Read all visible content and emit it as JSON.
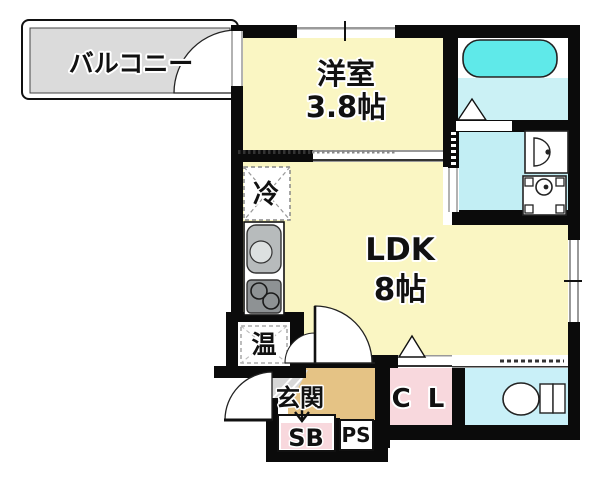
{
  "plan_title": "apartment-floor-plan",
  "rooms": {
    "balcony": {
      "label": "バルコニー"
    },
    "western_room": {
      "label": "洋室",
      "size": "3.8帖"
    },
    "ldk": {
      "label": "LDK",
      "size": "8帖"
    },
    "entrance": {
      "label": "玄関"
    },
    "closet": {
      "label": "C L"
    },
    "shoe_box": {
      "label": "SB"
    },
    "pipe_space": {
      "label": "PS"
    }
  },
  "fixtures": {
    "refrigerator": {
      "label": "冷"
    },
    "water_heater": {
      "label": "温"
    },
    "bathtub": {
      "icon": "bathtub-icon"
    },
    "bathroom_door": {
      "icon": "door-triangle-icon"
    },
    "washbasin": {
      "icon": "washbasin-icon"
    },
    "washing_machine": {
      "icon": "washing-machine-icon"
    },
    "kitchen_sink": {
      "icon": "sink-icon"
    },
    "kitchen_stove": {
      "icon": "stove-icon"
    },
    "toilet": {
      "icon": "toilet-icon"
    },
    "entrance_arrow": {
      "icon": "arrow-down-icon"
    }
  },
  "colors": {
    "room_yellow": "#FAF6C3",
    "balcony_gray": "#DBDBDB",
    "bathtub_cyan": "#5FE9E9",
    "bath_floor_cyan": "#CBF1F5",
    "washroom_cyan": "#C2EEF4",
    "toilet_cyan": "#C9F0F8",
    "closet_pink": "#F8D8DD",
    "entrance_tan": "#E5C385",
    "tile_gray": "#D8D8D8",
    "wall_black": "#0B0B0B",
    "sink_gray": "#B7BBBC",
    "stove_gray": "#8E9294"
  }
}
